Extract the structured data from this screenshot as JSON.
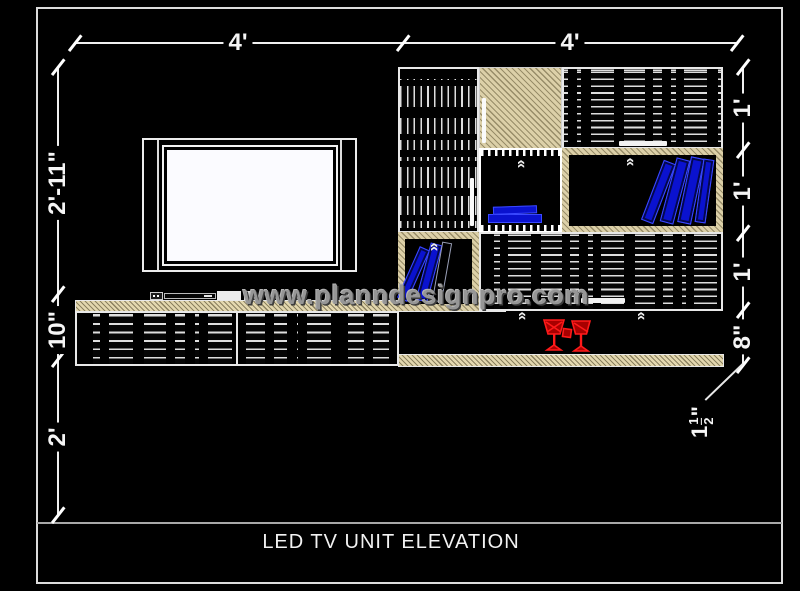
{
  "title": {
    "text": "LED TV UNIT ELEVATION"
  },
  "watermark": {
    "text": "www.planndesignpro.com"
  },
  "dimensions": {
    "top": [
      "4'",
      "4'"
    ],
    "left": [
      "2'-11\"",
      "10\"",
      "2'"
    ],
    "right": [
      "1'",
      "1'",
      "1'",
      "8\""
    ],
    "leader": {
      "whole": "1",
      "numerator": "1",
      "denominator": "2",
      "unit": "\""
    }
  },
  "icons": {
    "chevron": "«",
    "wine_glasses": "wine-glasses",
    "books": "books"
  },
  "colors": {
    "background": "#000000",
    "line_white": "#f0f0f0",
    "wood_tan": "#dcd0a8",
    "book_blue": "#0a12cf",
    "glass_red": "#d40000",
    "watermark_gray": "#969696",
    "separator_gray": "#a8a8a8"
  }
}
